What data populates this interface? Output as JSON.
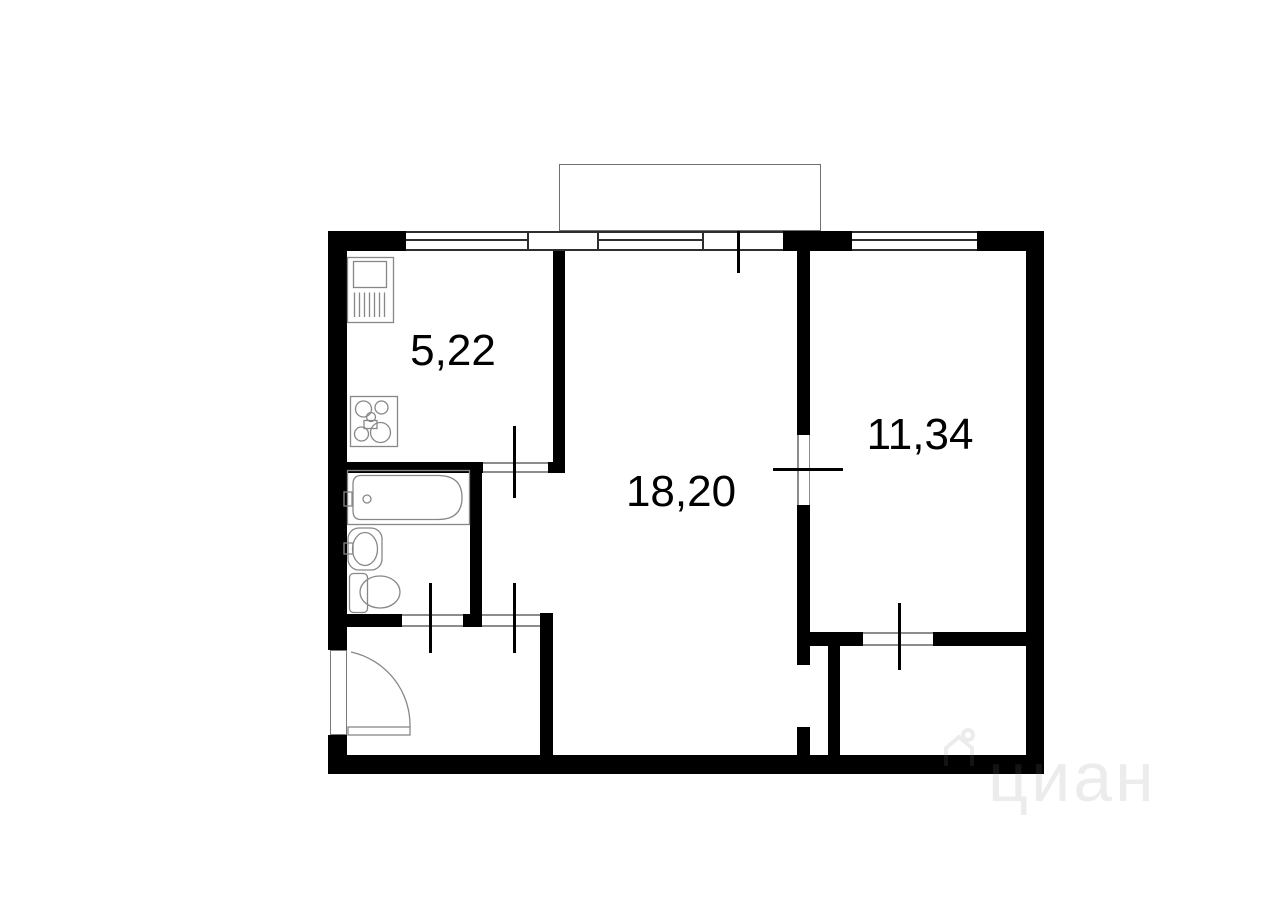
{
  "plan": {
    "type": "apartment-floor-plan",
    "rooms": [
      {
        "name": "kitchen",
        "area_label": "5,22"
      },
      {
        "name": "living-room",
        "area_label": "18,20"
      },
      {
        "name": "bedroom",
        "area_label": "11,34"
      }
    ],
    "fixtures": [
      "kitchen-sink-icon",
      "stove-icon",
      "bathtub-icon",
      "washbasin-icon",
      "toilet-icon",
      "entry-door-icon"
    ],
    "watermark": {
      "brand": "циан",
      "logo": "cian-house-icon"
    },
    "colors": {
      "wall": "#000000",
      "window_line": "#2e2e2e",
      "opening_line": "#8c8c8c",
      "fixture_line": "#878787",
      "balcony_line": "#6f6f6f",
      "watermark_on_white": "#ececec",
      "background": "#ffffff"
    }
  }
}
